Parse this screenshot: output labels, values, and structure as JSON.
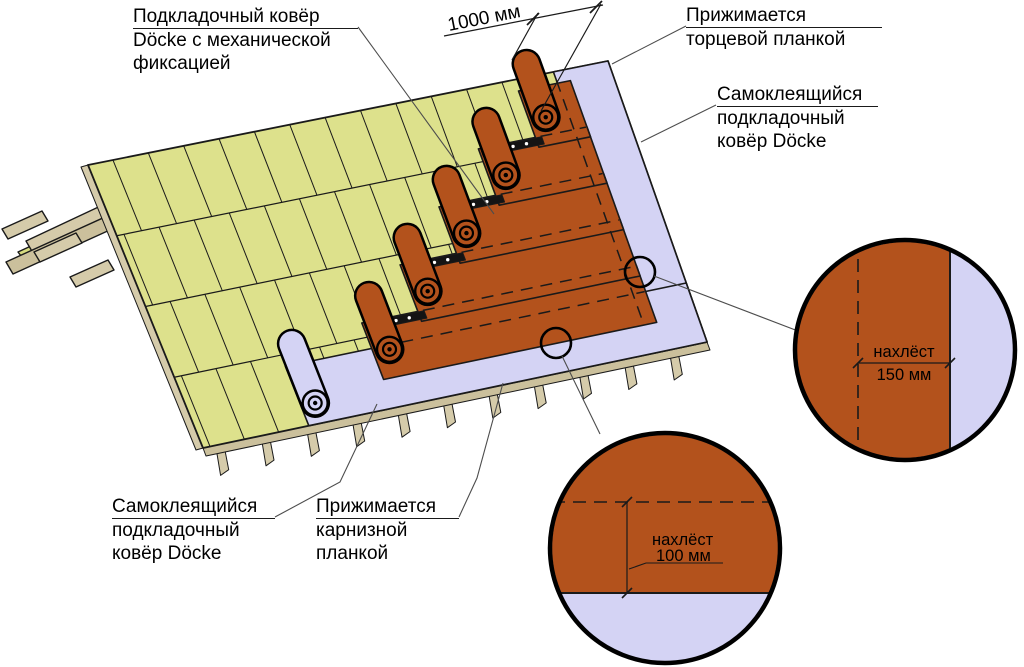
{
  "labels": {
    "underlayment_mech": {
      "line1": "Подкладочный ковёр",
      "line2": "Döcke с механической",
      "line3": "фиксацией"
    },
    "pressed_end_strip": {
      "line1": "Прижимается",
      "line2": "торцевой планкой"
    },
    "self_adhesive_gable": {
      "line1": "Самоклеящийся",
      "line2": "подкладочный",
      "line3": "ковёр Döcke"
    },
    "self_adhesive_eaves": {
      "line1": "Самоклеящийся",
      "line2": "подкладочный",
      "line3": "ковёр Döcke"
    },
    "pressed_eaves_strip": {
      "line1": "Прижимается",
      "line2": "карнизной",
      "line3": "планкой"
    }
  },
  "dimensions": {
    "roll_width": "1000 мм",
    "overlap_side_label": "нахлёст",
    "overlap_side_value": "150 мм",
    "overlap_course_label": "нахлёст",
    "overlap_course_value": "100 мм"
  },
  "colors": {
    "deck": "#dde18c",
    "deck_hatch": "#d6db7f",
    "wood": "#d5cbaa",
    "wood_dark": "#cbc09c",
    "orange": "#b3521c",
    "lavender": "#d4d3f4",
    "nail_strip": "#141414",
    "outline": "#1a1a1a",
    "leader": "#4d4d4d"
  }
}
